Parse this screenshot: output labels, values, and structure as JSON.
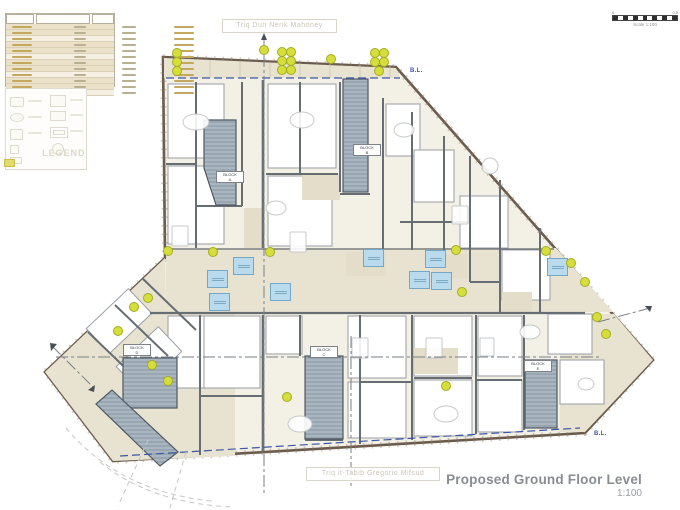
{
  "document": {
    "title": "Proposed Ground Floor Level",
    "scale_text": "1:100"
  },
  "scale_bar": {
    "zero_label": "0",
    "end_label": "0.5",
    "caption": "Scale 1:100"
  },
  "streets": {
    "top": "Triq Dun Nerik Mahoney",
    "bottom": "Triq it-Tabib Gregorio Mifsud"
  },
  "boundary": {
    "label": "B.L."
  },
  "legend": {
    "title": "LEGEND"
  },
  "schedule": {
    "row_count": 12
  },
  "blocks": [
    {
      "id": "block-a",
      "line1": "BLOCK",
      "line2": "A",
      "x": 229,
      "y": 177
    },
    {
      "id": "block-b",
      "line1": "BLOCK",
      "line2": "B",
      "x": 366,
      "y": 150
    },
    {
      "id": "block-c",
      "line1": "BLOCK",
      "line2": "C",
      "x": 323,
      "y": 352
    },
    {
      "id": "block-d",
      "line1": "BLOCK",
      "line2": "D",
      "x": 136,
      "y": 350
    },
    {
      "id": "block-e",
      "line1": "BLOCK",
      "line2": "E",
      "x": 537,
      "y": 366
    }
  ],
  "shafts": [
    [
      216,
      278
    ],
    [
      218,
      301
    ],
    [
      242,
      265
    ],
    [
      279,
      291
    ],
    [
      372,
      257
    ],
    [
      434,
      258
    ],
    [
      418,
      279
    ],
    [
      440,
      280
    ],
    [
      556,
      266
    ]
  ],
  "planters": [
    [
      176,
      52
    ],
    [
      176,
      61
    ],
    [
      176,
      70
    ],
    [
      263,
      49
    ],
    [
      281,
      51
    ],
    [
      290,
      51
    ],
    [
      281,
      60
    ],
    [
      290,
      60
    ],
    [
      281,
      69
    ],
    [
      290,
      69
    ],
    [
      330,
      58
    ],
    [
      374,
      52
    ],
    [
      383,
      52
    ],
    [
      374,
      61
    ],
    [
      383,
      61
    ],
    [
      378,
      70
    ],
    [
      167,
      250
    ],
    [
      147,
      297
    ],
    [
      133,
      306
    ],
    [
      117,
      330
    ],
    [
      151,
      364
    ],
    [
      167,
      380
    ],
    [
      212,
      251
    ],
    [
      269,
      251
    ],
    [
      455,
      249
    ],
    [
      461,
      291
    ],
    [
      545,
      250
    ],
    [
      570,
      262
    ],
    [
      584,
      281
    ],
    [
      596,
      316
    ],
    [
      605,
      333
    ],
    [
      445,
      385
    ],
    [
      286,
      396
    ]
  ],
  "colors": {
    "site_beige": "#e8e3d1",
    "core_gray": "#a9b6c1",
    "shaft_blue": "#badbed",
    "planter_yellow": "#d6de3c",
    "boundary_blue": "#3d56a6",
    "title_gray": "#878d93"
  }
}
